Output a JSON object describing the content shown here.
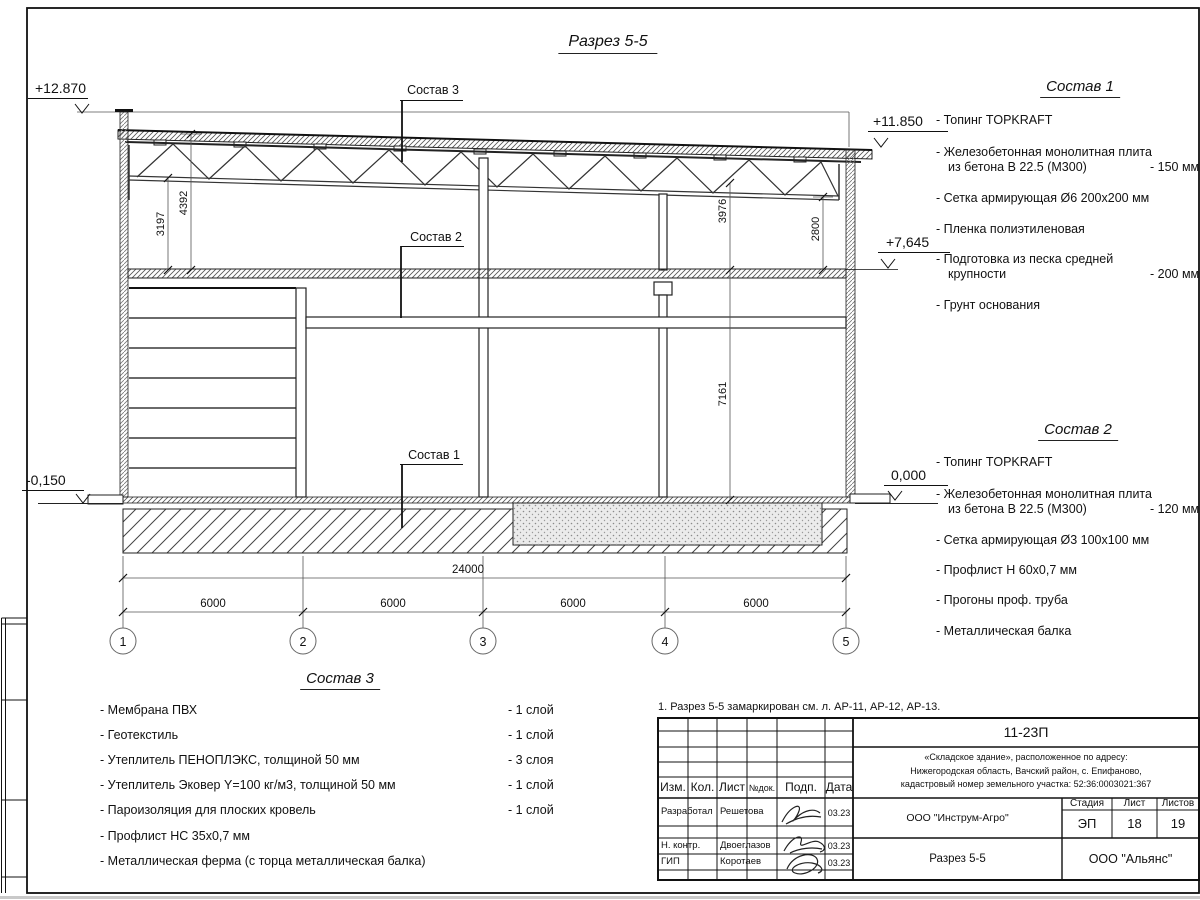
{
  "sheet": {
    "title": "Разрез 5-5",
    "note": "1. Разрез 5-5 замаркирован см. л. АР-11, АР-12, АР-13."
  },
  "drawing": {
    "elevations": {
      "parapet": "+12.870",
      "roof_right": "+11.850",
      "floor2_right": "+7,645",
      "zero_right": "0,000",
      "ground_left": "-0,150"
    },
    "dims": {
      "truss_left": "3197",
      "roof_left": "4392",
      "truss_right": "3976",
      "truss_right2": "2800",
      "hall_height": "7161",
      "total": "24000",
      "bays": [
        "6000",
        "6000",
        "6000",
        "6000"
      ]
    },
    "axes": [
      "1",
      "2",
      "3",
      "4",
      "5"
    ],
    "callouts": {
      "sostav1": "Состав 1",
      "sostav2": "Состав 2",
      "sostav3": "Состав 3"
    }
  },
  "sostav1": {
    "heading": "Состав 1",
    "items": [
      {
        "line1": "- Топинг TOPKRAFT",
        "line2": "",
        "value": ""
      },
      {
        "line1": "- Железобетонная  монолитная плита",
        "line2": "из бетона  В 22.5 (М300)",
        "value": "- 150 мм"
      },
      {
        "line1": "- Сетка армирующая Ø6 200x200 мм",
        "line2": "",
        "value": ""
      },
      {
        "line1": "- Пленка полиэтиленовая",
        "line2": "",
        "value": ""
      },
      {
        "line1": "- Подготовка из песка средней",
        "line2": "крупности",
        "value": "- 200 мм"
      },
      {
        "line1": "- Грунт основания",
        "line2": "",
        "value": ""
      }
    ]
  },
  "sostav2": {
    "heading": "Состав 2",
    "items": [
      {
        "line1": "- Топинг TOPKRAFT",
        "line2": "",
        "value": ""
      },
      {
        "line1": "- Железобетонная  монолитная плита",
        "line2": "из бетона  В 22.5 (М300)",
        "value": "- 120 мм"
      },
      {
        "line1": "- Сетка армирующая Ø3 100x100 мм",
        "line2": "",
        "value": ""
      },
      {
        "line1": "- Профлист Н 60x0,7 мм",
        "line2": "",
        "value": ""
      },
      {
        "line1": "- Прогоны проф. труба",
        "line2": "",
        "value": ""
      },
      {
        "line1": "- Металлическая балка",
        "line2": "",
        "value": ""
      }
    ]
  },
  "sostav3": {
    "heading": "Состав 3",
    "items": [
      {
        "text": "- Мембрана ПВХ",
        "value": "- 1 слой"
      },
      {
        "text": "- Геотекстиль",
        "value": "- 1 слой"
      },
      {
        "text": "- Утеплитель ПЕНОПЛЭКС, толщиной 50 мм",
        "value": "- 3 слоя"
      },
      {
        "text": "- Утеплитель Эковер Y=100 кг/м3, толщиной 50 мм",
        "value": "- 1 слой"
      },
      {
        "text": "- Пароизоляция для плоских кровель",
        "value": "- 1 слой"
      },
      {
        "text": "- Профлист НС 35x0,7 мм",
        "value": ""
      },
      {
        "text": "- Металлическая ферма (с торца металлическая балка)",
        "value": ""
      }
    ]
  },
  "stamp": {
    "doc_number": "11-23П",
    "project_lines": [
      "«Складское здание», расположенное по адресу:",
      "Нижегородская область, Вачский район, с. Епифаново,",
      "кадастровый номер земельного участка: 52:36:0003021:367"
    ],
    "columns": {
      "izm": "Изм.",
      "kol": "Кол.",
      "list": "Лист",
      "ndok": "№док.",
      "podp": "Подп.",
      "data": "Дата"
    },
    "rows": [
      {
        "role": "Разработал",
        "name": "Решетова",
        "date": "03.23"
      },
      {
        "role": "Н. контр.",
        "name": "Двоеглазов",
        "date": "03.23"
      },
      {
        "role": "ГИП",
        "name": "Коротаев",
        "date": "03.23"
      }
    ],
    "org": "ООО \"Инструм-Агро\"",
    "stage_label": "Стадия",
    "sheet_label": "Лист",
    "sheets_label": "Листов",
    "stage": "ЭП",
    "sheet": "18",
    "sheets": "19",
    "drawing_title": "Разрез 5-5",
    "customer": "ООО \"Альянс\""
  }
}
